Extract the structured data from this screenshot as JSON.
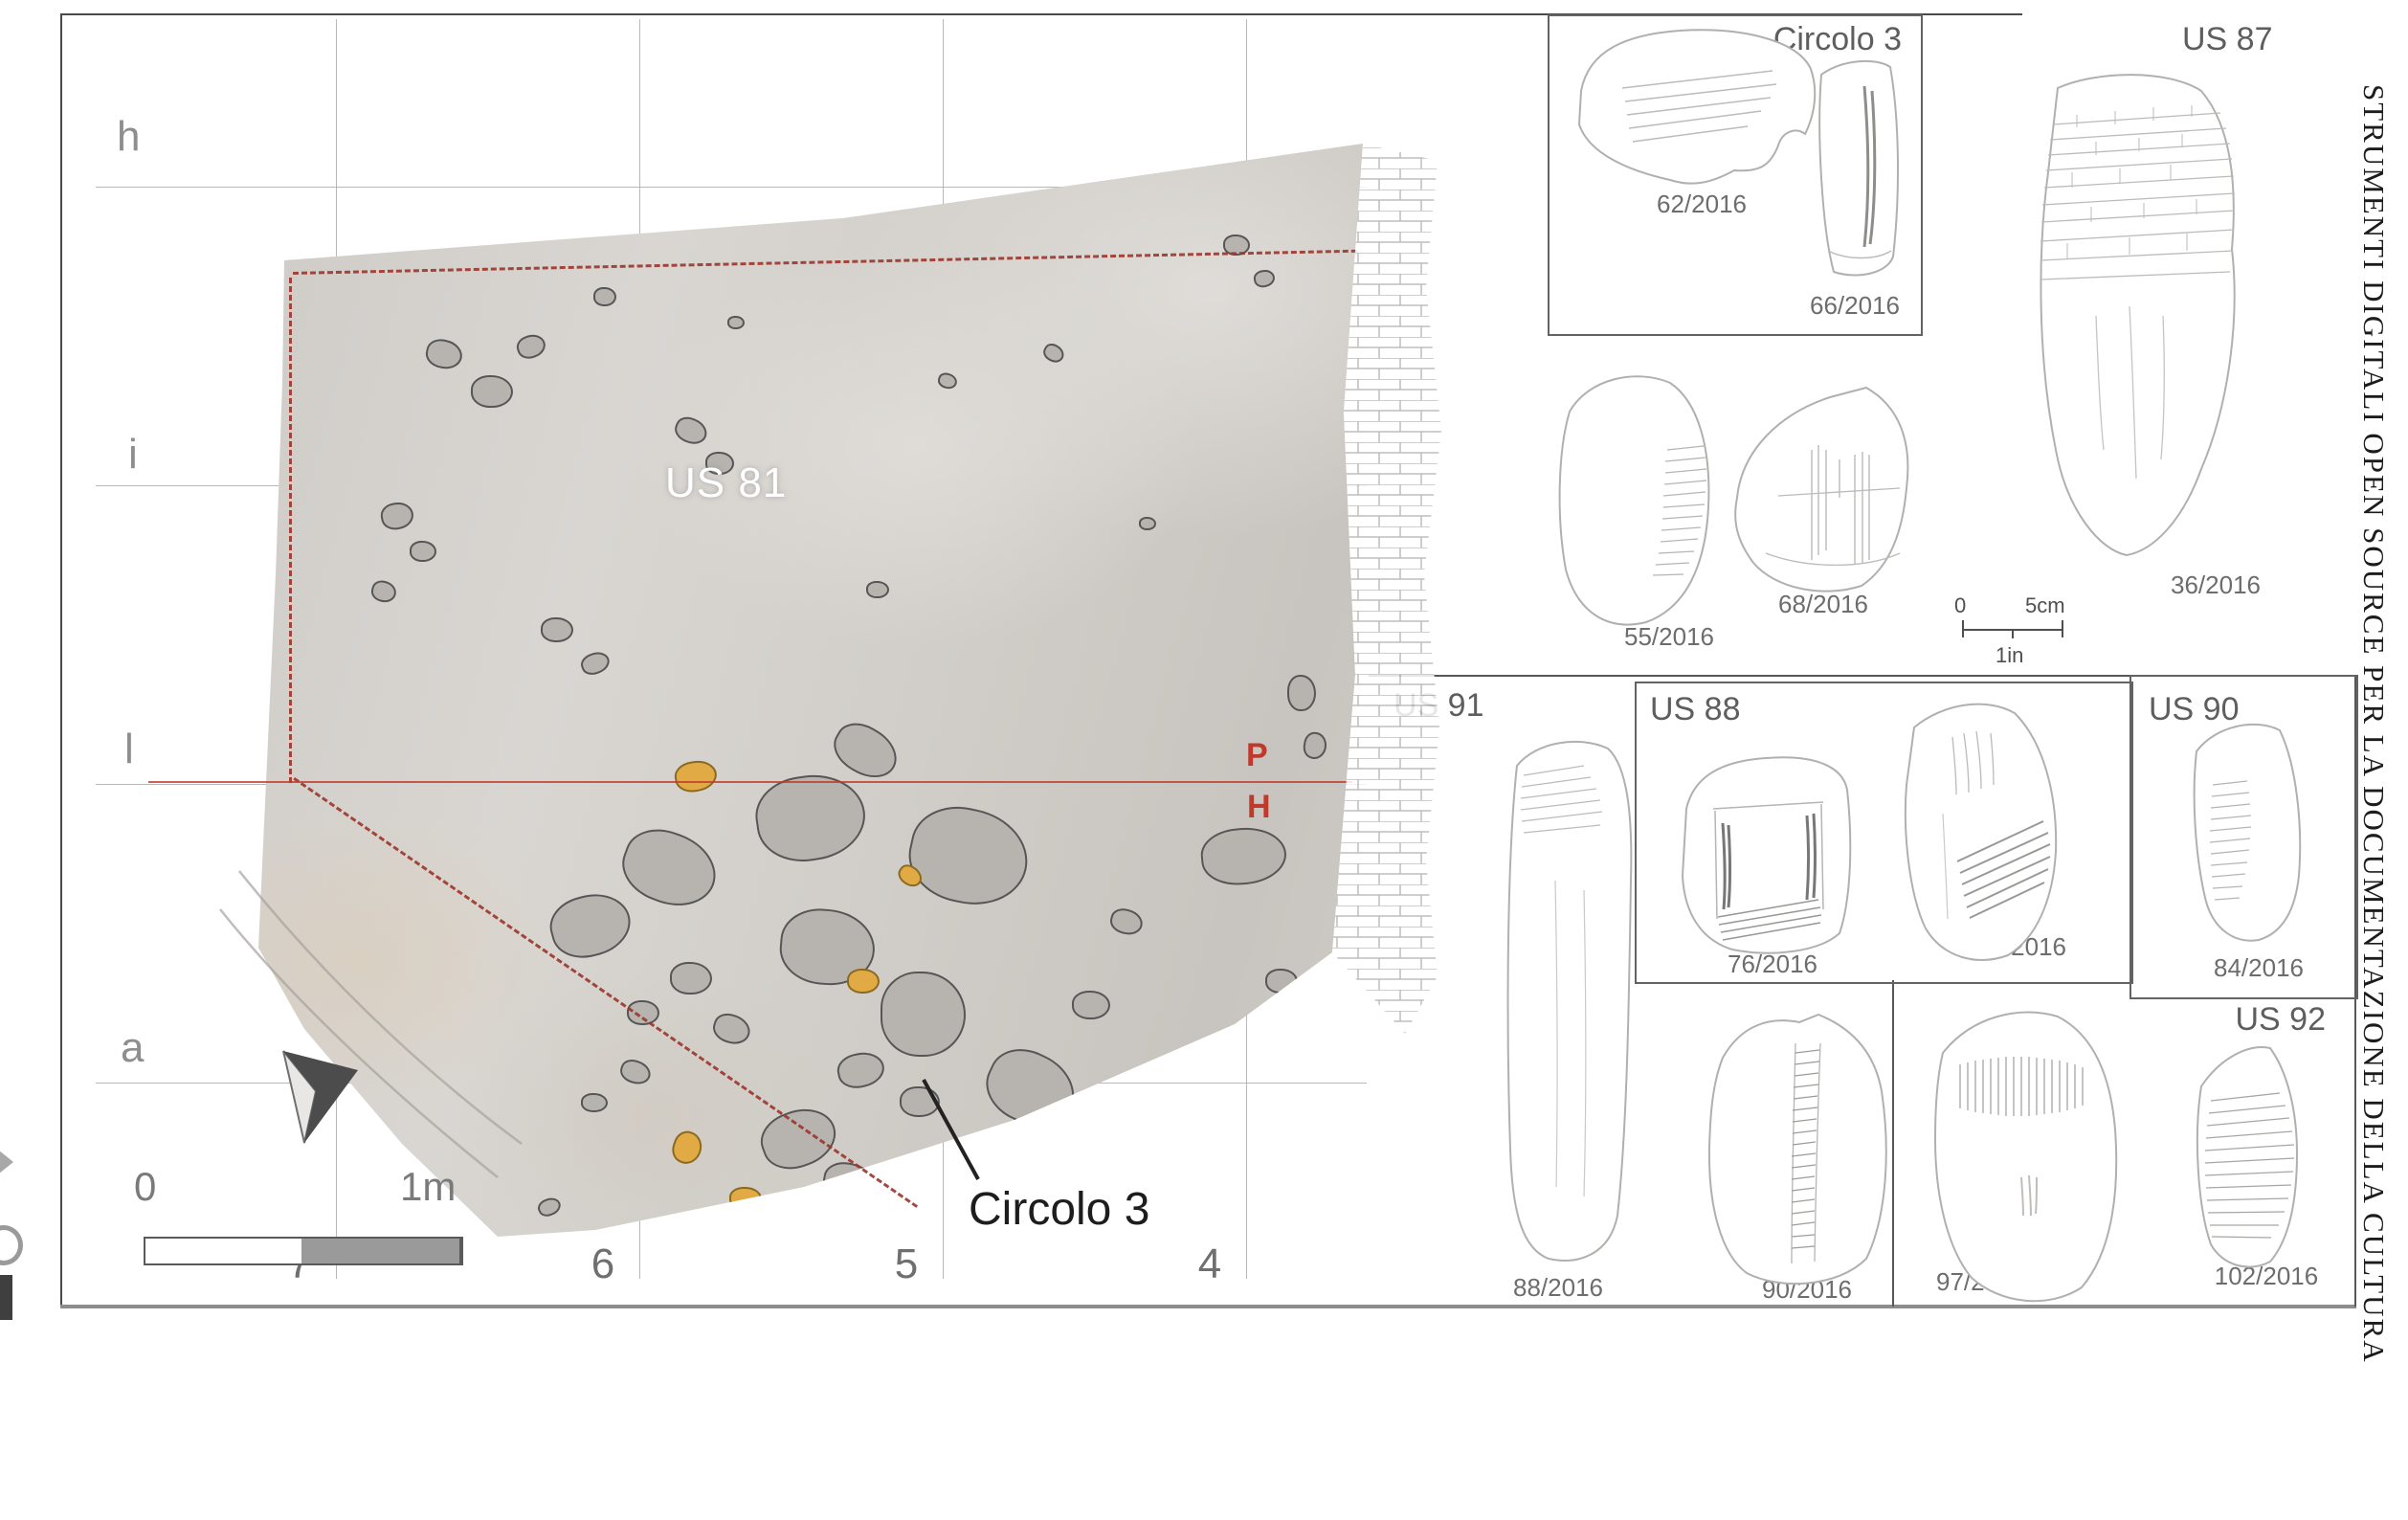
{
  "margin": {
    "vertical_title": "STRUMENTI DIGITALI OPEN SOURCE PER LA DOCUMENTAZIONE DELLA CULTURA"
  },
  "plan": {
    "row_labels": [
      "h",
      "i",
      "l",
      "a"
    ],
    "col_labels": [
      "7",
      "6",
      "5",
      "4"
    ],
    "unit_label": "US 81",
    "feature_label": "Circolo 3",
    "section_top": "P",
    "section_bottom": "H",
    "scale_zero": "0",
    "scale_end": "1m"
  },
  "catalog": {
    "box_circolo3": {
      "label": "Circolo 3",
      "item1": "62/2016",
      "item2": "66/2016"
    },
    "us87": {
      "label": "US 87",
      "item1": "36/2016"
    },
    "loose": {
      "item1": "55/2016",
      "item2": "68/2016"
    },
    "scale": {
      "zero": "0",
      "cm": "5cm",
      "inch": "1in"
    },
    "us91": {
      "label": "US 91",
      "item1": "88/2016",
      "item2": "90/2016"
    },
    "us88": {
      "label": "US 88",
      "item1": "76/2016",
      "item2": "87/2016"
    },
    "us90": {
      "label": "US 90",
      "item1": "84/2016"
    },
    "us92": {
      "label": "US 92",
      "item1": "97/2016",
      "item2": "102/2016"
    }
  },
  "colors": {
    "accent_red": "#b03a2e",
    "grid": "#ababab",
    "sketch": "#b2b0ad"
  }
}
